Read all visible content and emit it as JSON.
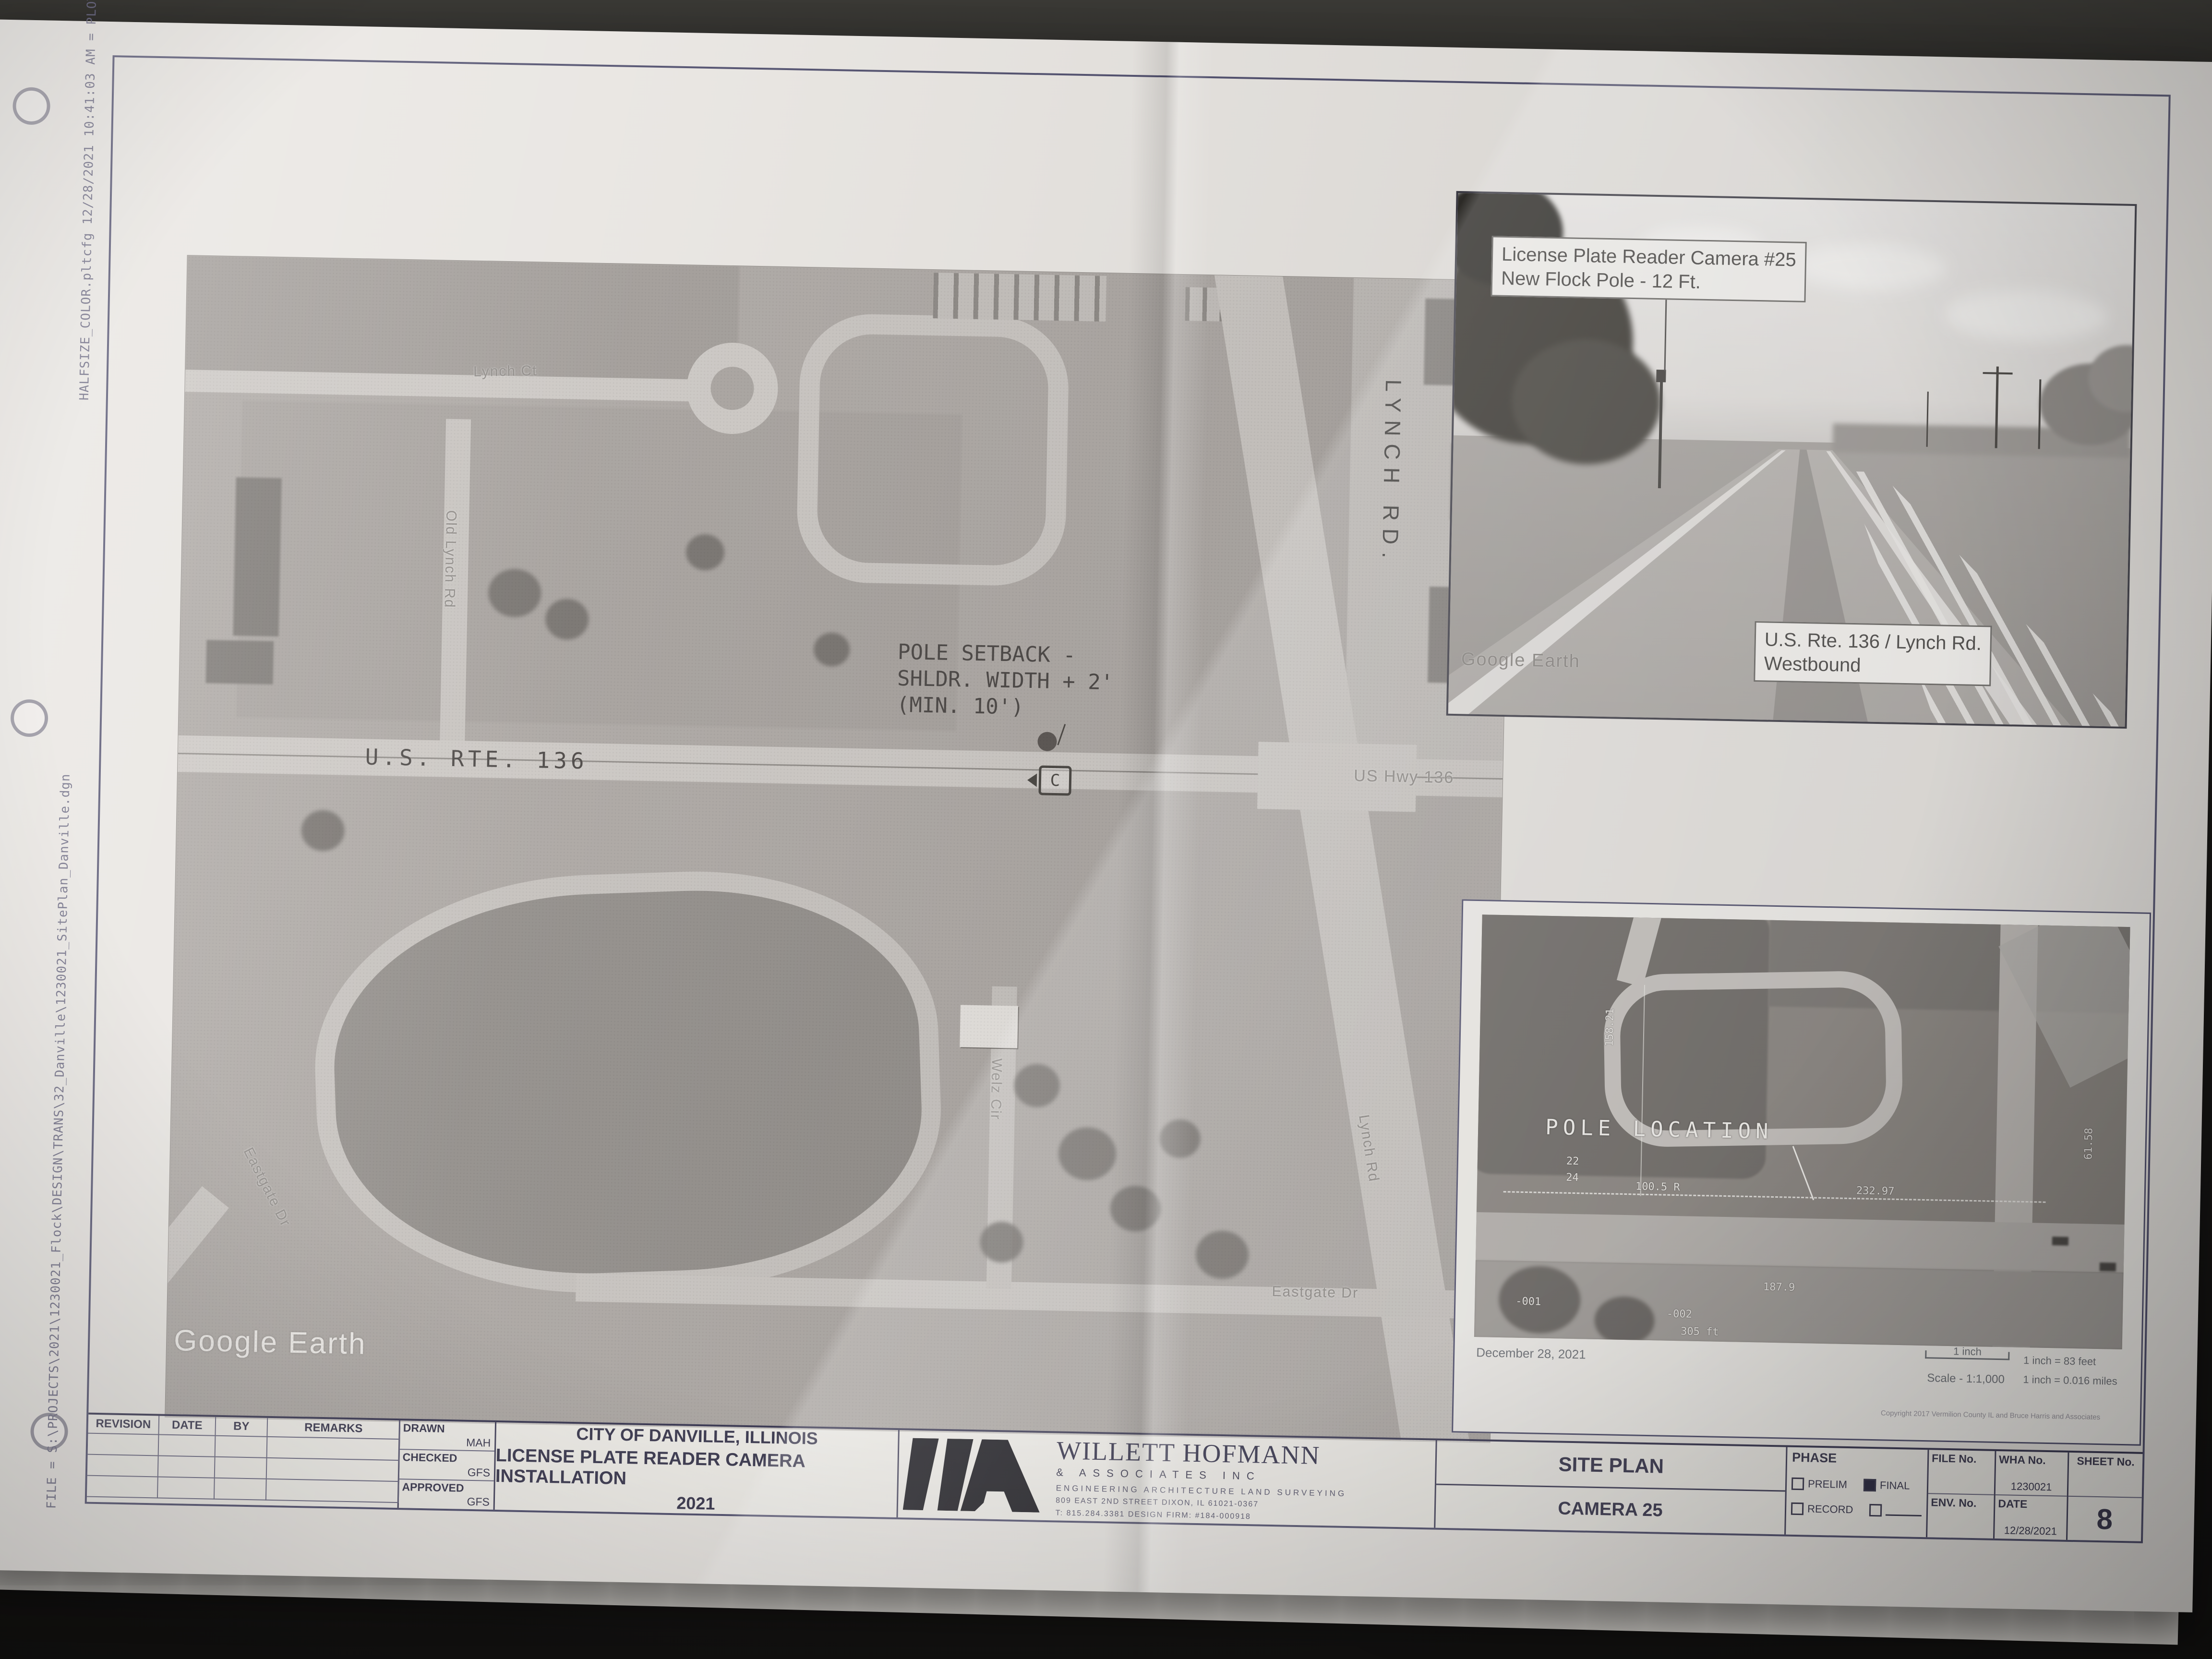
{
  "stamps": {
    "top": "HALFSIZE_COLOR.pltcfg 12/28/2021 10:41:03 AM = PLOTTED",
    "left": "FILE = S:\\PROJECTS\\2021\\1230021_Flock\\DESIGN\\TRANS\\32_Danville\\1230021_SitePlan_Danville.dgn"
  },
  "main_map": {
    "streets": {
      "lynch_ct": "Lynch Ct",
      "old_lynch_rd": "Old Lynch Rd",
      "us_rte_136": "U.S. RTE. 136",
      "us_hwy_136": "US Hwy 136",
      "lynch_rd_vertical": "LYNCH RD.",
      "lynch_rd_diagonal": "Lynch Rd",
      "welz_cir": "Welz Cir",
      "eastgate_dr_diagonal": "Eastgate Dr",
      "eastgate_dr": "Eastgate Dr"
    },
    "annotation": {
      "line1": "POLE SETBACK -",
      "line2": "SHLDR. WIDTH + 2'",
      "line3": "(MIN. 10')",
      "camera_letter": "C"
    },
    "watermark": "Google Earth"
  },
  "photo_inset": {
    "callout_line1": "License Plate Reader Camera #25",
    "callout_line2": "New Flock Pole - 12 Ft.",
    "location_line1": "U.S. Rte. 136 / Lynch Rd.",
    "location_line2": "Westbound",
    "watermark": "Google Earth"
  },
  "map_inset": {
    "pole_label": "POLE LOCATION",
    "dims": [
      "158.21",
      "22",
      "24",
      "100.5 R",
      "232.97",
      "187.9",
      "-001",
      "-002",
      "305 ft",
      "61.58"
    ],
    "date": "December 28, 2021",
    "scale_bar_label": "1 inch",
    "scale_text": "Scale - 1:1,000",
    "scale_feet": "1 inch = 83 feet",
    "scale_miles": "1 inch = 0.016 miles",
    "copyright": "Copyright 2017 Vermilion County IL and Bruce Harris and Associates"
  },
  "titleblock": {
    "rev_headers": [
      "REVISION",
      "DATE",
      "BY",
      "REMARKS"
    ],
    "drawn_label": "DRAWN",
    "drawn_value": "MAH",
    "checked_label": "CHECKED",
    "checked_value": "GFS",
    "approved_label": "APPROVED",
    "approved_value": "GFS",
    "project_line1": "CITY OF DANVILLE, ILLINOIS",
    "project_line2": "LICENSE PLATE READER CAMERA INSTALLATION",
    "project_line3": "2021",
    "firm_name": "WILLETT HOFMANN",
    "firm_sub": "& ASSOCIATES INC",
    "firm_services": "ENGINEERING   ARCHITECTURE   LAND SURVEYING",
    "firm_address": "809 EAST 2ND STREET  DIXON, IL 61021-0367",
    "firm_contact": "T: 815.284.3381   DESIGN FIRM: #184-000918",
    "sheet_title": "SITE PLAN",
    "sheet_subtitle": "CAMERA 25",
    "phase_label": "PHASE",
    "phase_options": [
      "PRELIM",
      "FINAL",
      "RECORD"
    ],
    "file_no_label": "FILE No.",
    "env_no_label": "ENV. No.",
    "wha_no_label": "WHA No.",
    "wha_no_value": "1230021",
    "date_label": "DATE",
    "date_value": "12/28/2021",
    "sheet_no_label": "SHEET No.",
    "sheet_no_value": "8"
  },
  "colors": {
    "paper": "#e8e5e1",
    "desk": "#1c1b19",
    "plot_line": "#51506e",
    "aerial_gray": "#aca7a3"
  }
}
